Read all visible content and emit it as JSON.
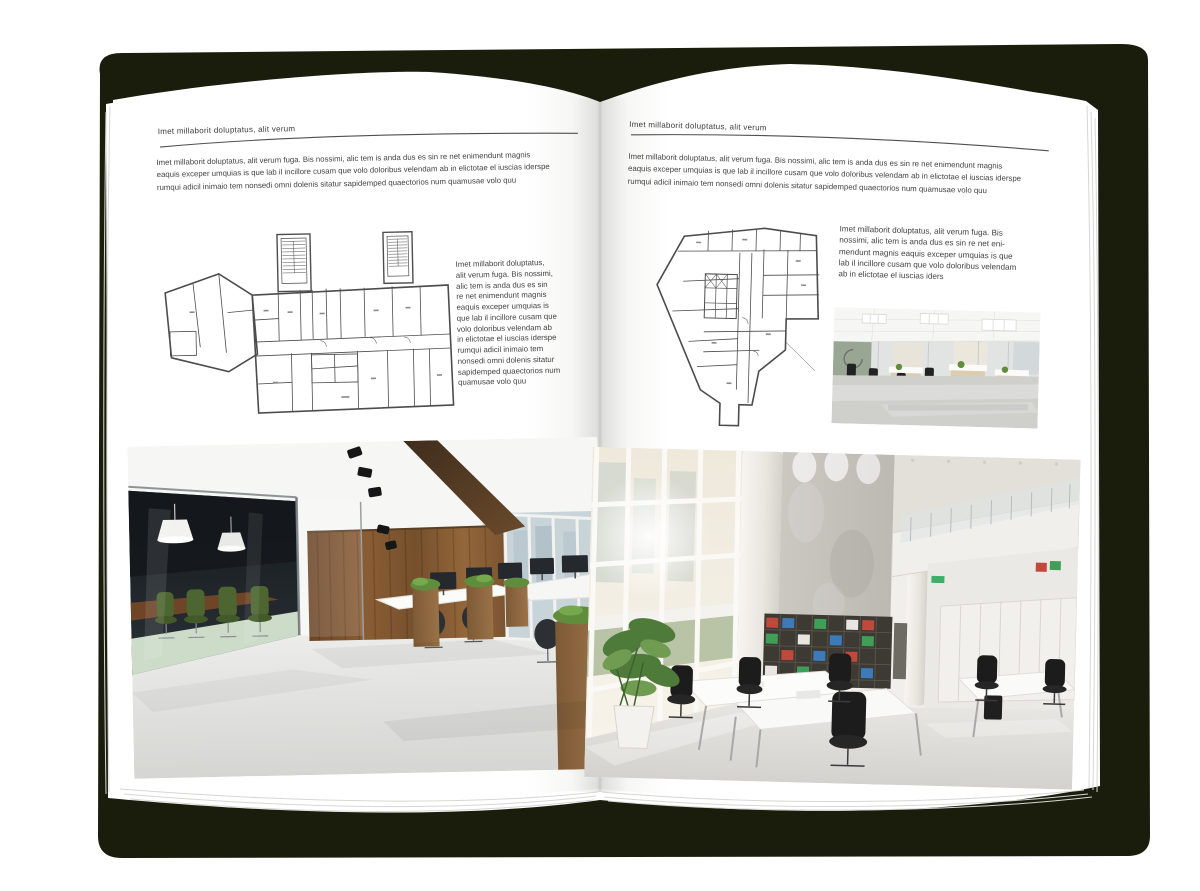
{
  "palette": {
    "cover": "#1b1d0c",
    "page": "#ffffff",
    "text": "#424242",
    "rule_line": "#4f4f4f",
    "plan_line": "#4c4c4c",
    "wood": "#7a5130",
    "plant_green": "#5f8d3b"
  },
  "left_page": {
    "header": "Imet millaborit doluptatus, alit verum",
    "intro": "Imet millaborit doluptatus, alit verum fuga. Bis nossimi, alic tem is anda dus es sin re net enimendunt magnis\neaquis exceper umquias is que lab il incillore cusam que volo doloribus velendam ab in elictotae el iuscias iderspe\nrumqui adicil inimaio tem nonsedi omni dolenis sitatur sapidemped quaectorios num quamusae volo quu",
    "side_text": "Imet millaborit doluptatus,\nalit verum fuga. Bis nossimi,\nalic tem is anda dus es sin\nre net enimendunt magnis\neaquis exceper umquias is\nque lab il incillore cusam que\nvolo doloribus velendam ab\nin elictotae el iuscias iderspe\nrumqui adicil inimaio tem\nnonsedi omni dolenis sitatur\nsapidemped quaectorios num\nquamusae volo quu",
    "floorplan_alt": "wide-building-floor-plan-with-two-stair-towers",
    "photo_alt": "office-interior-glass-meeting-room-wood-wall"
  },
  "right_page": {
    "header": "Imet millaborit doluptatus, alit verum",
    "intro": "Imet millaborit doluptatus, alit verum fuga. Bis nossimi, alic tem is anda dus es sin re net enimendunt magnis\neaquis exceper umquias is que lab il incillore cusam que volo doloribus velendam ab in elictotae el iuscias iderspe\nrumqui adicil inimaio tem nonsedi omni dolenis sitatur sapidemped quaectorios num quamusae volo quu",
    "side_text": "Imet millaborit doluptatus, alit verum fuga. Bis\nnossimi, alic tem is anda dus es sin re net eni-\nmendunt magnis eaquis exceper umquias is que\nlab il incillore cusam que volo doloribus velendam\nab in elictotae el iuscias iders",
    "floorplan_alt": "irregular-building-floor-plan-with-elevator-core",
    "photo_small_alt": "bright-open-office-workstations",
    "photo_alt": "double-height-office-atrium-bookshelf"
  }
}
